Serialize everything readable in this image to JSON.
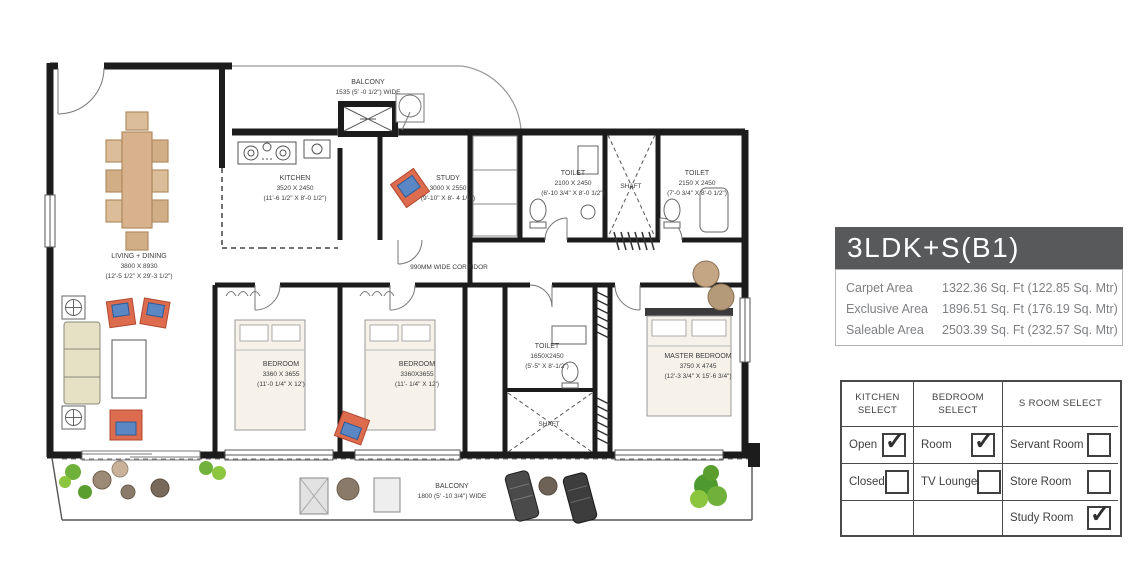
{
  "panel": {
    "title": "3LDK+S(B1)",
    "areas": [
      {
        "label": "Carpet Area",
        "value": "1322.36 Sq. Ft (122.85 Sq. Mtr)"
      },
      {
        "label": "Exclusive Area",
        "value": "1896.51 Sq. Ft (176.19 Sq. Mtr)"
      },
      {
        "label": "Saleable Area",
        "value": "2503.39 Sq. Ft (232.57 Sq. Mtr)"
      }
    ]
  },
  "options_table": {
    "columns": [
      {
        "header": "KITCHEN SELECT",
        "rows": [
          {
            "label": "Open",
            "checked": true
          },
          {
            "label": "Closed",
            "checked": false
          },
          {
            "label": "",
            "checked": null
          }
        ]
      },
      {
        "header": "BEDROOM SELECT",
        "rows": [
          {
            "label": "Room",
            "checked": true
          },
          {
            "label": "TV Lounge",
            "checked": false
          },
          {
            "label": "",
            "checked": null
          }
        ]
      },
      {
        "header": "S ROOM SELECT",
        "rows": [
          {
            "label": "Servant Room",
            "checked": false
          },
          {
            "label": "Store  Room",
            "checked": false
          },
          {
            "label": "Study Room",
            "checked": true
          }
        ]
      }
    ]
  },
  "plan": {
    "rooms": {
      "balcony_top": {
        "name": "BALCONY",
        "dims": "1535 (5' -0 1/2\") WIDE"
      },
      "kitchen": {
        "name": "KITCHEN",
        "dims": "3520 X 2450",
        "imperial": "(11'-6 1/2\" X 8'-0 1/2\")"
      },
      "study": {
        "name": "STUDY",
        "dims": "3000 X 2550",
        "imperial": "(9'-10\" X 8'- 4 1/2\")"
      },
      "toilet1": {
        "name": "TOILET",
        "dims": "2100 X 2450",
        "imperial": "(6'-10 3/4\" X 8'-0 1/2\")"
      },
      "shaft_top": {
        "name": "SHAFT"
      },
      "toilet2": {
        "name": "TOILET",
        "dims": "2150 X 2450",
        "imperial": "(7'-0 3/4\" X 8'-0 1/2\")"
      },
      "living_dining": {
        "name": "LIVING + DINING",
        "dims": "3800 X 8930",
        "imperial": "(12'-5 1/2\" X 29'-3 1/2\")"
      },
      "corridor": {
        "name": "990MM WIDE CORRIDOR"
      },
      "bedroom1": {
        "name": "BEDROOM",
        "dims": "3360 X 3655",
        "imperial": "(11'-0 1/4\" X 12')"
      },
      "bedroom2": {
        "name": "BEDROOM",
        "dims": "3360X3655",
        "imperial": "(11'- 1/4\" X 12')"
      },
      "toilet3": {
        "name": "TOILET",
        "dims": "1650X2450",
        "imperial": "(5'-5\" X 8'-1/2\")"
      },
      "shaft_mid": {
        "name": "SHAFT"
      },
      "master_bedroom": {
        "name": "MASTER BEDROOM",
        "dims": "3750 X 4745",
        "imperial": "(12'-3 3/4\" X 15'-6 3/4\")"
      },
      "balcony_bottom": {
        "name": "BALCONY",
        "dims": "1800 (5' -10 3/4\") WIDE"
      }
    }
  },
  "colors": {
    "panel_title_bg": "#58595b",
    "wall": "#1c1c1c",
    "chair_orange": "#dd6b4d",
    "cushion_blue": "#5b87c5",
    "wood_tan": "#d7b28c",
    "sofa_beige": "#e6e0c4",
    "plant_green": "#6fb13a"
  }
}
